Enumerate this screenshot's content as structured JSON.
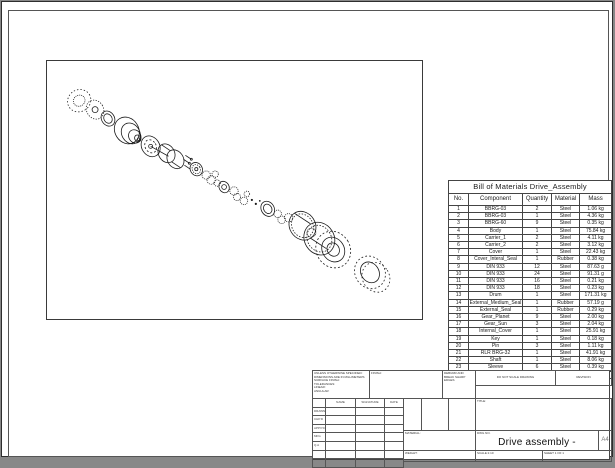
{
  "bom": {
    "title": "Bill of Materials Drive_Assembly",
    "columns": [
      "No.",
      "Component",
      "Quantity",
      "Material",
      "Mass"
    ],
    "rows": [
      [
        "1",
        "BBRG-03",
        "2",
        "Steel",
        "1.06 kg"
      ],
      [
        "2",
        "BBRG-03",
        "1",
        "Steel",
        "4.36 kg"
      ],
      [
        "3",
        "BBRG-60",
        "9",
        "Steel",
        "0.35 kg"
      ],
      [
        "4",
        "Body",
        "1",
        "Steel",
        "75.84 kg"
      ],
      [
        "5",
        "Carrier_1",
        "2",
        "Steel",
        "4.11 kg"
      ],
      [
        "6",
        "Carrier_2",
        "2",
        "Steel",
        "3.12 kg"
      ],
      [
        "7",
        "Cover",
        "1",
        "Steel",
        "22.43 kg"
      ],
      [
        "8",
        "Cover_Interal_Seal",
        "1",
        "Rubber",
        "0.38 kg"
      ],
      [
        "9",
        "DIN 933",
        "12",
        "Steel",
        "87.63 g"
      ],
      [
        "10",
        "DIN 933",
        "24",
        "Steel",
        "91.31 g"
      ],
      [
        "11",
        "DIN 933",
        "16",
        "Steel",
        "0.21 kg"
      ],
      [
        "12",
        "DIN 933",
        "18",
        "Steel",
        "0.23 kg"
      ],
      [
        "13",
        "Drum",
        "1",
        "Steel",
        "171.31 kg"
      ],
      [
        "14",
        "External_Medium_Seal",
        "1",
        "Rubber",
        "57.19 g"
      ],
      [
        "15",
        "External_Seal",
        "1",
        "Rubber",
        "0.29 kg"
      ],
      [
        "16",
        "Gear_Planet",
        "9",
        "Steel",
        "2.00 kg"
      ],
      [
        "17",
        "Gear_Sun",
        "3",
        "Steel",
        "2.04 kg"
      ],
      [
        "18",
        "Internal_Cover",
        "1",
        "Steel",
        "25.91 kg"
      ],
      [
        "19",
        "Key",
        "1",
        "Steel",
        "0.18 kg"
      ],
      [
        "20",
        "Pin",
        "3",
        "Steel",
        "1.11 kg"
      ],
      [
        "21",
        "RLR BRG-32",
        "1",
        "Steel",
        "41.91 kg"
      ],
      [
        "22",
        "Shaft",
        "1",
        "Steel",
        "8.06 kg"
      ],
      [
        "23",
        "Sleeve",
        "6",
        "Steel",
        "0.39 kg"
      ],
      [
        "24",
        "Sprocket",
        "1",
        "Steel",
        "73.02 kg"
      ],
      [
        "25",
        "Washer",
        "1",
        "Steel",
        "10.15 kg"
      ]
    ]
  },
  "title_block": {
    "tolerance_note": "UNLESS OTHERWISE SPECIFIED:\nDIMENSIONS ARE IN MILLIMETERS\nSURFACE FINISH:\nTOLERANCES:\n   LINEAR:\n   ANGULAR:",
    "finish_label": "FINISH:",
    "deburr_note": "DEBURR AND BREAK SHARP EDGES",
    "do_not_scale": "DO NOT SCALE DRAWING",
    "revision_label": "REVISION",
    "approvals": {
      "headers": [
        "NAME",
        "SIGNATURE",
        "DATE"
      ],
      "rows": [
        "DRAWN",
        "CHK'D",
        "APPV'D",
        "MFG",
        "Q.A"
      ]
    },
    "material_label": "MATERIAL:",
    "weight_label": "WEIGHT:",
    "title_label": "TITLE:",
    "dwg_no_label": "DWG NO.",
    "drawing_title": "Drive assembly - exploded",
    "sheet_size": "A4",
    "scale_label": "SCALE:1:10",
    "sheet_label": "SHEET 1 OF 1"
  }
}
